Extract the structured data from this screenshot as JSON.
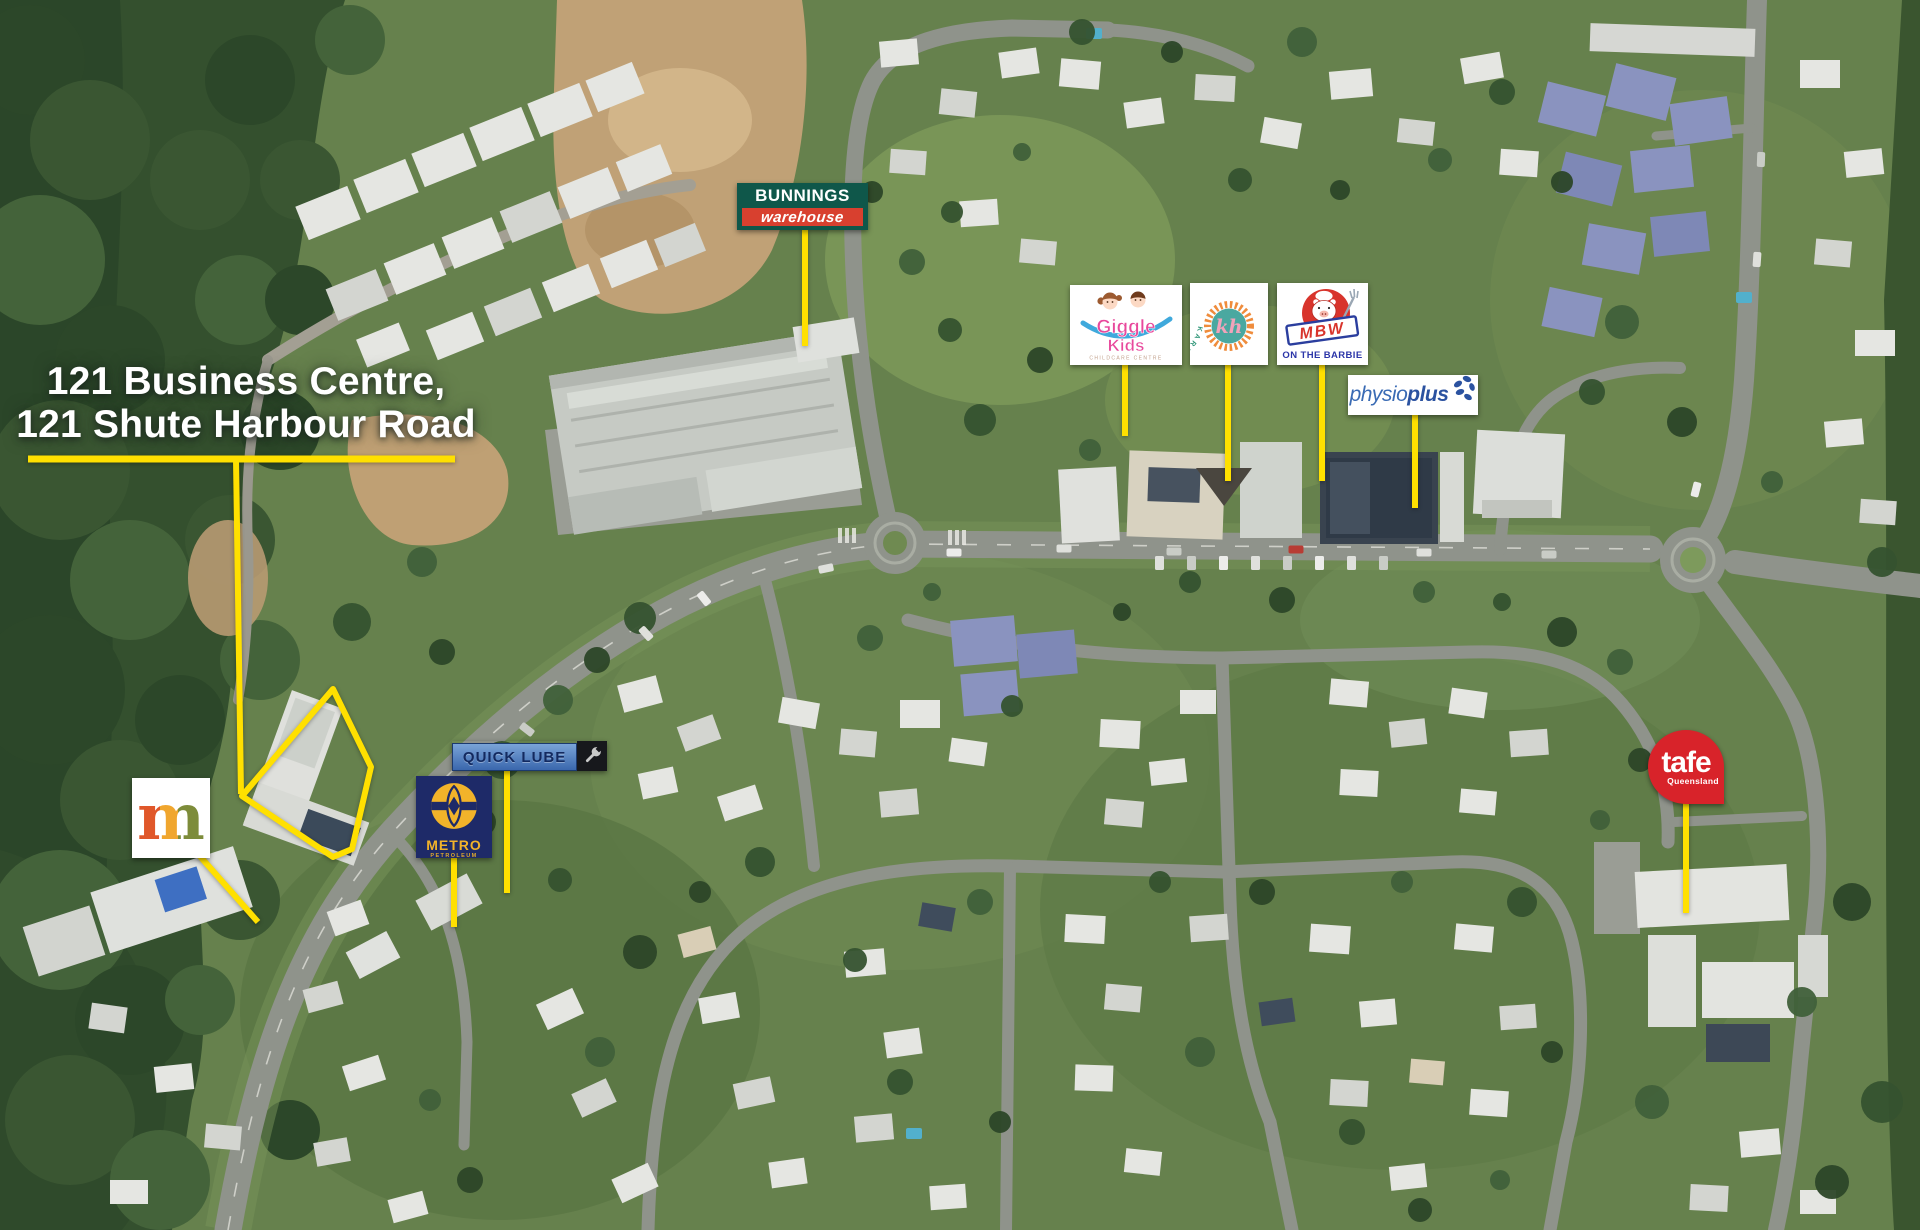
{
  "annotation": {
    "color": "#FFE000",
    "address": {
      "line1": "121 Business Centre,",
      "line2": "121 Shute Harbour Road"
    }
  },
  "logos": {
    "bunnings": {
      "line1": "BUNNINGS",
      "line2": "warehouse",
      "green": "#0F574A",
      "red": "#D8402F"
    },
    "giggle_kids": {
      "word1": "Giggle",
      "word2": "Kids",
      "tagline": "CHILDCARE CENTRE",
      "pink": "#E8489C",
      "blue": "#3FA9DC"
    },
    "karen_hill": {
      "ring_text": "KAREN HILL FLORAL DESIGN",
      "monogram": "kh",
      "orange": "#EF8C3C",
      "teal": "#4AA8A0",
      "pink": "#F2A3BA"
    },
    "mbw": {
      "name": "MBW",
      "tagline": "ON THE BARBIE",
      "red": "#D8342C",
      "blue": "#2B35A8"
    },
    "physioplus": {
      "word1": "physio",
      "word2": "plus",
      "blue": "#2B52A0"
    },
    "quick_lube": {
      "name": "QUICK LUBE",
      "navy": "#132A60"
    },
    "metro": {
      "name": "METRO",
      "sub": "PETROLEUM",
      "navy": "#1E2A68",
      "gold": "#F2B32A"
    },
    "m_centre": {
      "letter": "m",
      "colors": [
        "#E0572A",
        "#F0A62E",
        "#7D8C3A"
      ]
    },
    "tafe": {
      "name": "tafe",
      "sub": "Queensland",
      "red": "#D8232A"
    }
  }
}
